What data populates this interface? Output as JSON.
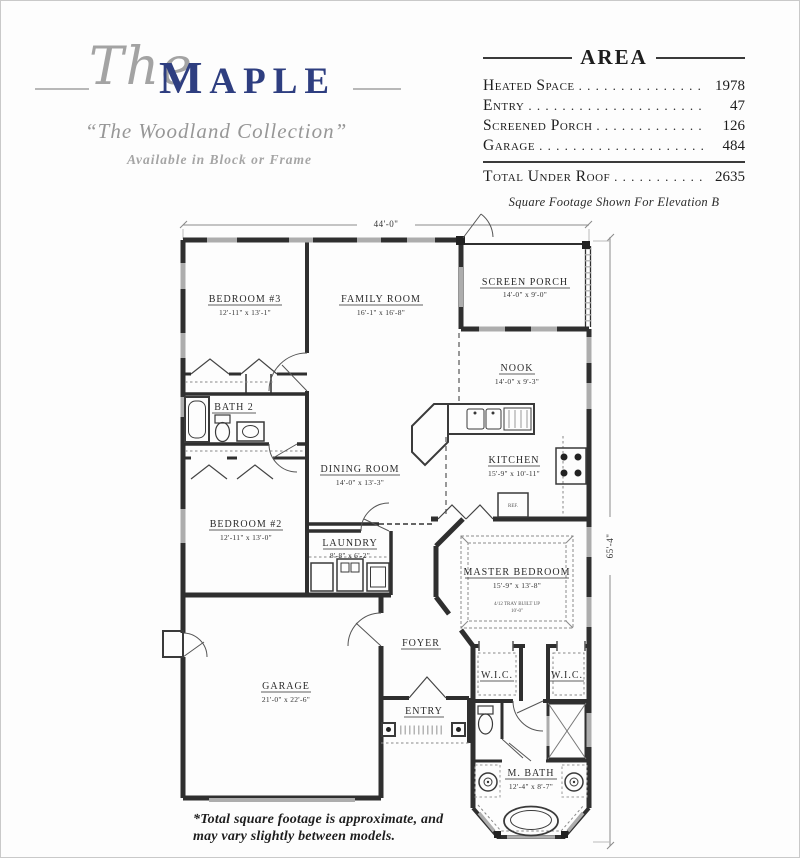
{
  "header": {
    "the": "The",
    "name_first": "M",
    "name_rest": "APLE",
    "collection": "“The Woodland Collection”",
    "availability": "Available in Block or Frame"
  },
  "area_table": {
    "title": "AREA",
    "rows": [
      {
        "label": "Heated Space",
        "value": "1978"
      },
      {
        "label": "Entry",
        "value": "47"
      },
      {
        "label": "Screened Porch",
        "value": "126"
      },
      {
        "label": "Garage",
        "value": "484"
      }
    ],
    "total": {
      "label": "Total Under Roof",
      "value": "2635"
    },
    "note": "Square Footage Shown For Elevation B"
  },
  "plan": {
    "dim_width_label": "44'-0\"",
    "dim_height_label": "65'-4\"",
    "fridge_label": "REF.",
    "rooms": [
      {
        "name": "BEDROOM #3",
        "dims": "12'-11\" x 13'-1\""
      },
      {
        "name": "FAMILY ROOM",
        "dims": "16'-1\" x 16'-8\""
      },
      {
        "name": "SCREEN PORCH",
        "dims": "14'-0\" x 9'-0\""
      },
      {
        "name": "NOOK",
        "dims": "14'-0\" x 9'-3\""
      },
      {
        "name": "BATH 2",
        "dims": ""
      },
      {
        "name": "KITCHEN",
        "dims": "15'-9\" x 10'-11\""
      },
      {
        "name": "DINING ROOM",
        "dims": "14'-0\" x 13'-3\""
      },
      {
        "name": "BEDROOM #2",
        "dims": "12'-11\" x 13'-0\""
      },
      {
        "name": "LAUNDRY",
        "dims": "8'-8\" x 6'-2\""
      },
      {
        "name": "MASTER BEDROOM",
        "dims": "15'-9\" x 13'-8\"",
        "note1": "4/12 TRAY BUILT UP",
        "note2": "10'-0\""
      },
      {
        "name": "FOYER",
        "dims": ""
      },
      {
        "name": "W.I.C.",
        "dims": ""
      },
      {
        "name": "W.I.C.",
        "dims": ""
      },
      {
        "name": "GARAGE",
        "dims": "21'-0\" x 22'-6\""
      },
      {
        "name": "ENTRY",
        "dims": ""
      },
      {
        "name": "M. BATH",
        "dims": "12'-4\" x 8'-7\""
      }
    ]
  },
  "footer": {
    "line1": "*Total square footage is approximate, and",
    "line2": "may vary slightly between models."
  }
}
